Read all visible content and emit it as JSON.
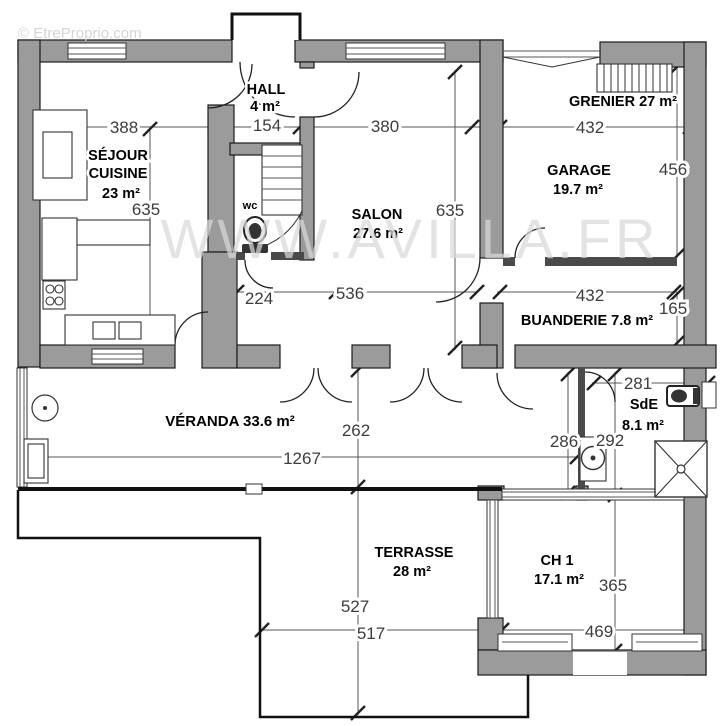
{
  "watermarks": {
    "top": "© EtreProprio.com",
    "center": "WWW.AVILLA.FR"
  },
  "rooms": {
    "hall": {
      "name": "HALL",
      "area": "4 m²"
    },
    "sejour": {
      "line1": "SÉJOUR",
      "line2": "CUISINE",
      "area": "23 m²"
    },
    "salon": {
      "name": "SALON",
      "area": "27.6 m²"
    },
    "garage": {
      "name": "GARAGE",
      "area": "19.7 m²"
    },
    "grenier": {
      "label": "GRENIER 27 m²"
    },
    "buanderie": {
      "label": "BUANDERIE  7.8 m²"
    },
    "wc": {
      "name": "wc"
    },
    "sde": {
      "name": "SdE",
      "area": "8.1 m²"
    },
    "veranda": {
      "label": "VÉRANDA  33.6 m²"
    },
    "terrasse": {
      "name": "TERRASSE",
      "area": "28 m²"
    },
    "ch1": {
      "name": "CH 1",
      "area": "17.1 m²"
    }
  },
  "dims": {
    "sejour_width": "388",
    "hall_width": "154",
    "salon_width": "380",
    "garage_width": "432",
    "sejour_depth": "635",
    "salon_depth": "635",
    "garage_depth": "456",
    "corridor": "224",
    "salon_lower": "536",
    "buanderie_width": "432",
    "buanderie_depth": "165",
    "sde_width": "281",
    "passage_depth": "286",
    "sde_depth": "292",
    "veranda_depth": "262",
    "veranda_width": "1267",
    "terrasse_depth": "527",
    "terrasse_width": "517",
    "ch1_depth": "365",
    "ch1_width": "469"
  },
  "colors": {
    "wall_fill": "#9b9b9b",
    "outline": "#1a1a1a",
    "dim_text": "#3d3d3d",
    "watermark": "#d9d9d9",
    "background": "#ffffff"
  }
}
